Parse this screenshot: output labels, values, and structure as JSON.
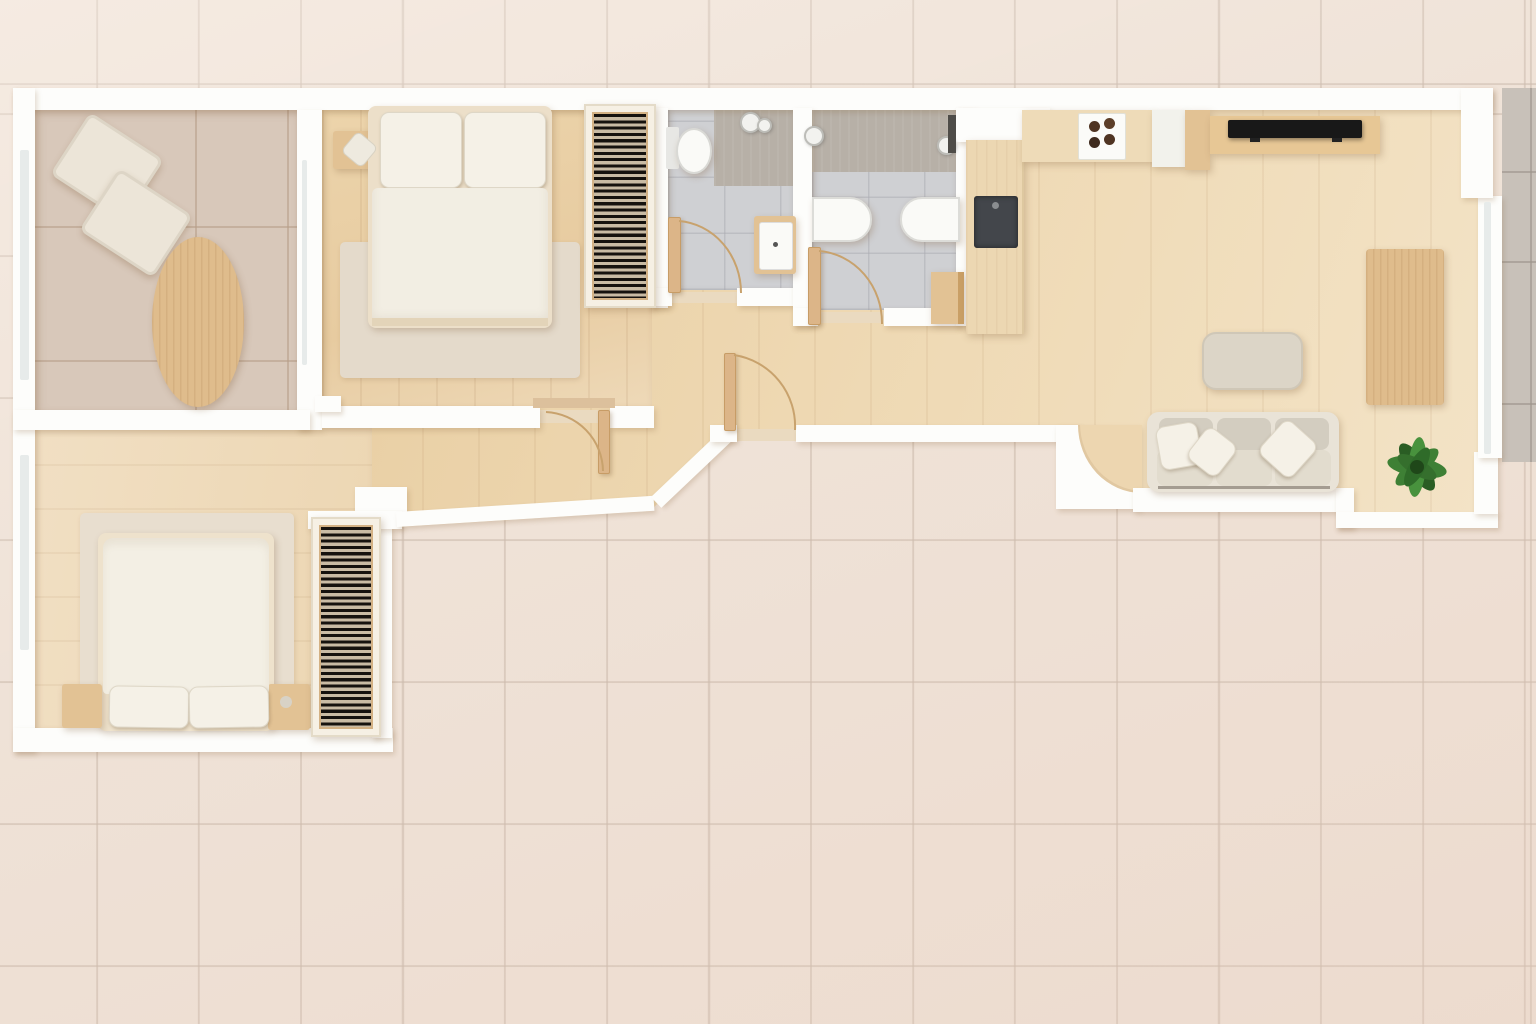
{
  "scene": {
    "type": "apartment-floor-plan",
    "view": "top-down-3d-render",
    "description": "Rendered top-view floor plan of a long apartment with two bedrooms, two bathrooms, an office lounge, an open kitchen-living-dining room, a hallway and a side terrace, surrounded by beige tiled paving"
  },
  "palette": {
    "exterior_tile": "#efe2d7",
    "exterior_grout": "rgba(203,186,172,0.6)",
    "terrace_tile": "#c8c1b9",
    "terrace_grout": "rgba(158,150,141,0.65)",
    "wall": "#fdfdfb",
    "glass": "#e7ebea",
    "sill_wood": "#eadac0",
    "room1_tile": "#d8c8ba",
    "room1_grout": "rgba(182,157,135,0.55)",
    "bath_tile": "#cfd0d3",
    "bath_grout": "rgba(170,171,178,0.5)",
    "shower": "#b7b0a7",
    "door_wood": "#dcb588",
    "door_edge": "#c79c66",
    "arc_stroke": "#c8a26d",
    "slat_frame": "#d3b184",
    "wardrobe_case": "#f6f0e4",
    "bed_frame": "#ecdfc9",
    "duvet": "#f2eee3",
    "pillow": "#f5f1e7",
    "rug": "#e4dacb",
    "nightstand_wood": "#e2c294",
    "table_wood": "#dfbc8c",
    "chairback_wood": "#d8b381",
    "lounge_chair": "#ece5d8",
    "sofa_frame": "#e9e3d7",
    "sofa_back": "#d3cdc0",
    "sofa_seat": "#e2dcce",
    "coffee_table": "#dcd5c7",
    "dining_chair": "#f0ede4",
    "counter_wood": "#ecd7b2",
    "counter_white": "#f2f2ec",
    "sink_dark": "#43464b",
    "hob_white": "#fbfbf8",
    "burner_brown": "#4f3422",
    "tv_black": "#181818",
    "fixture_white": "#fafaf7",
    "plant_green": "#3e8035",
    "plant_dark": "#2a5d24"
  },
  "rooms": [
    {
      "id": "office-lounge",
      "name": "office lounge with ceramic tile floor",
      "floor": "ceramic-tile",
      "furniture": [
        "lounge-chair",
        "lounge-chair",
        "oval-dining-table",
        "chair-backs-x6"
      ]
    },
    {
      "id": "bedroom-1",
      "name": "bedroom 1 with wood floor",
      "floor": "wood",
      "furniture": [
        "double-bed",
        "two-pillows",
        "nightstand",
        "rug",
        "black-slatted-wardrobe"
      ]
    },
    {
      "id": "bathroom-1",
      "name": "bathroom 1 with grey tile floor",
      "floor": "grey-tile",
      "furniture": [
        "toilet",
        "walk-in-shower",
        "washbasin-cabinet",
        "door"
      ]
    },
    {
      "id": "bathroom-2",
      "name": "bathroom 2 with grey tile floor",
      "floor": "grey-tile",
      "furniture": [
        "walk-in-shower",
        "bathtub",
        "washbasin",
        "wood-cabinet",
        "door"
      ]
    },
    {
      "id": "kitchen",
      "name": "open kitchen",
      "floor": "wood",
      "furniture": [
        "counter-with-dark-sink",
        "counter-with-hob",
        "white-tall-cabinet",
        "wood-cabinet"
      ]
    },
    {
      "id": "living-dining",
      "name": "living and dining room",
      "floor": "wood",
      "furniture": [
        "tv-sideboard",
        "flatscreen-tv",
        "dining-table",
        "dining-chairs-x6",
        "coffee-table",
        "three-seat-sofa",
        "throw-pillows-x3",
        "potted-plant"
      ]
    },
    {
      "id": "bedroom-2",
      "name": "bedroom 2 with wood floor",
      "floor": "wood",
      "furniture": [
        "double-bed",
        "two-pillows",
        "two-nightstands",
        "rug",
        "black-slatted-wardrobe"
      ]
    },
    {
      "id": "hallway",
      "name": "entrance hallway",
      "floor": "wood",
      "furniture": [
        "entrance-door",
        "bedroom-door"
      ]
    },
    {
      "id": "terrace",
      "name": "terrace with grey stone tiles",
      "floor": "stone-tile",
      "furniture": []
    }
  ]
}
